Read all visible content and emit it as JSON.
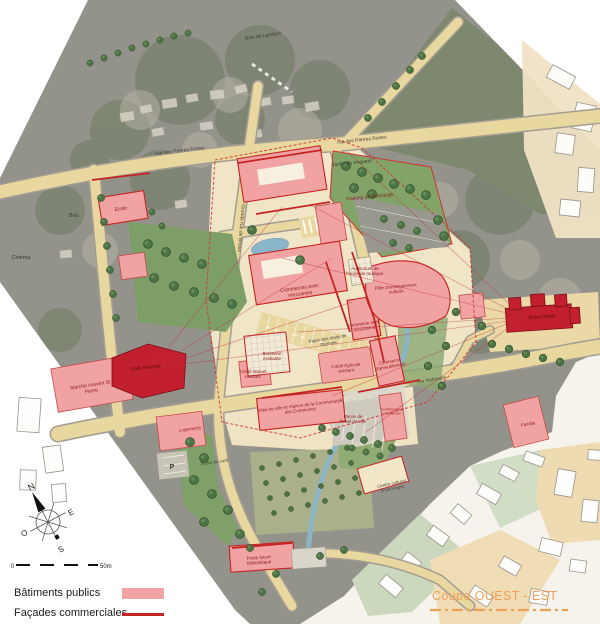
{
  "map": {
    "labels": {
      "bois_du_lambon": "Bois du Lambon",
      "rue_pierres_fortes_ouest": "rue des Pierres Fortes",
      "rue_pierres_fortes_est": "rue des Pierres Fortes",
      "jardin_du_troqueur": "Jardin du troqueur",
      "parking_delestage": "Parking de délestage",
      "bois": "Bois",
      "ecole": "Ecole",
      "grande_rue_de_brioux": "Grande rue de Brioux",
      "cinema": "Cinéma",
      "commerces_avec_mezzanine": "Commerces avec mezzanine",
      "auditorium": "Auditorium de l'école de musique",
      "pole_enseignement_culturel": "Pôle d'enseignement culturel",
      "commerce_avec_mezzanine": "Commerce avec mezzanine",
      "place_droits_homme": "Place des droits de l'homme",
      "brasserie_existante": "Brasserie existante",
      "credit_mutuel": "Crédit Mutuel existant",
      "credit_agricole": "Crédit Agricole existant",
      "commerce_ameublement": "Commerce d'ameublement",
      "rue_nationale": "rue Nationale",
      "marche_couvert": "Marché couvert St Pierre",
      "salle_plurielle": "Salle Plurielle",
      "hotel_de_ville": "Hôtel de ville et maison de la Communauté des Communes",
      "parvis_hotel_de_ville": "Parvis de l'hôtel de ville",
      "commerce_a_conserver": "Commerce à conserver",
      "notre_dame": "Notre Dame",
      "familia": "Familia",
      "logements": "Logements",
      "jardin_du_cure": "Jardin du curé",
      "centre_culturel": "Centre culturel (Patronage)",
      "poste_bibliotheque": "Poste future bibliothèque",
      "parking_p": "P"
    }
  },
  "legend": {
    "items": [
      {
        "label": "Bâtiments publics"
      },
      {
        "label": "Façades commerciales"
      }
    ]
  },
  "section_marker": {
    "label": "Coupe OUEST - EST"
  },
  "compass": {
    "north": "N",
    "east": "E",
    "south": "S",
    "west": "O"
  },
  "scale_bar": {
    "start": "0",
    "end": "50m"
  },
  "colors": {
    "public_buildings": "#f1a2a2",
    "commercial_facades": "#c62323",
    "section_line": "#efa057",
    "dark_red_landmark": "#c2202e",
    "road_yellow": "#e8d79e"
  }
}
